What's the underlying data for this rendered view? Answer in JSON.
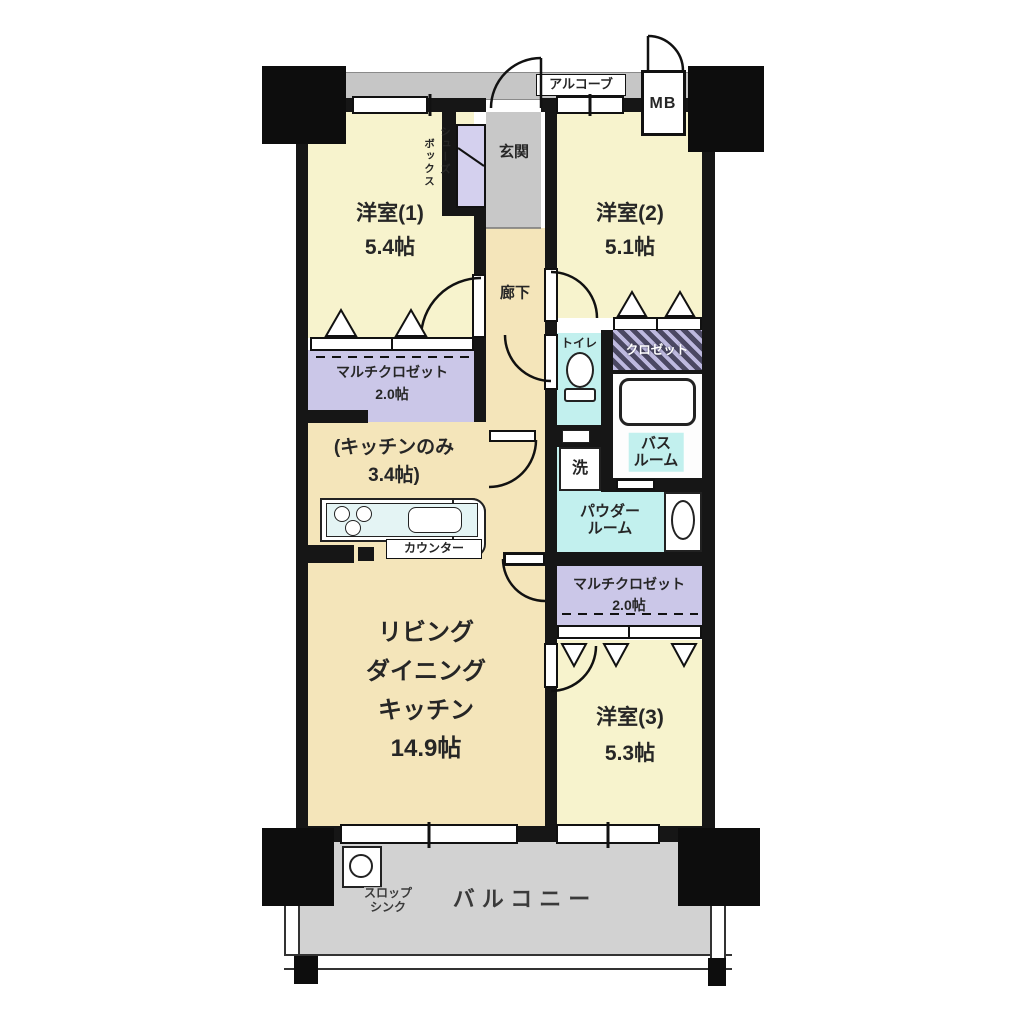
{
  "rooms": {
    "r1": {
      "name": "洋室(1)",
      "size": "5.4帖"
    },
    "r2": {
      "name": "洋室(2)",
      "size": "5.1帖"
    },
    "r3": {
      "name": "洋室(3)",
      "size": "5.3帖"
    },
    "ldk": {
      "l1": "リビング",
      "l2": "ダイニング",
      "l3": "キッチン",
      "size": "14.9帖"
    },
    "kitchen_note": {
      "l1": "(キッチンのみ",
      "l2": "3.4帖)"
    },
    "mc_top": {
      "name": "マルチクロゼット",
      "size": "2.0帖"
    },
    "mc_bottom": {
      "name": "マルチクロゼット",
      "size": "2.0帖"
    },
    "closet": "クロゼット",
    "genkan": "玄関",
    "rouka": "廊下",
    "toilet": "トイレ",
    "bath": {
      "l1": "バス",
      "l2": "ルーム"
    },
    "powder": {
      "l1": "パウダー",
      "l2": "ルーム"
    },
    "wash": "洗",
    "shoes": {
      "c1": "シューズ",
      "c2": "ボックス"
    },
    "alcove": "アルコーブ",
    "mb": "MB",
    "balcony": "バルコニー",
    "slop": {
      "l1": "スロップ",
      "l2": "シンク"
    },
    "counter": "カウンター"
  },
  "colors": {
    "wall": "#161616",
    "bedroom": "#f7f3cd",
    "ldk": "#f4e5ba",
    "closet": "#cbc7e8",
    "wet_area": "#c2f0ee",
    "entrance": "#c8c8c8",
    "balcony": "#d2d2d2"
  }
}
